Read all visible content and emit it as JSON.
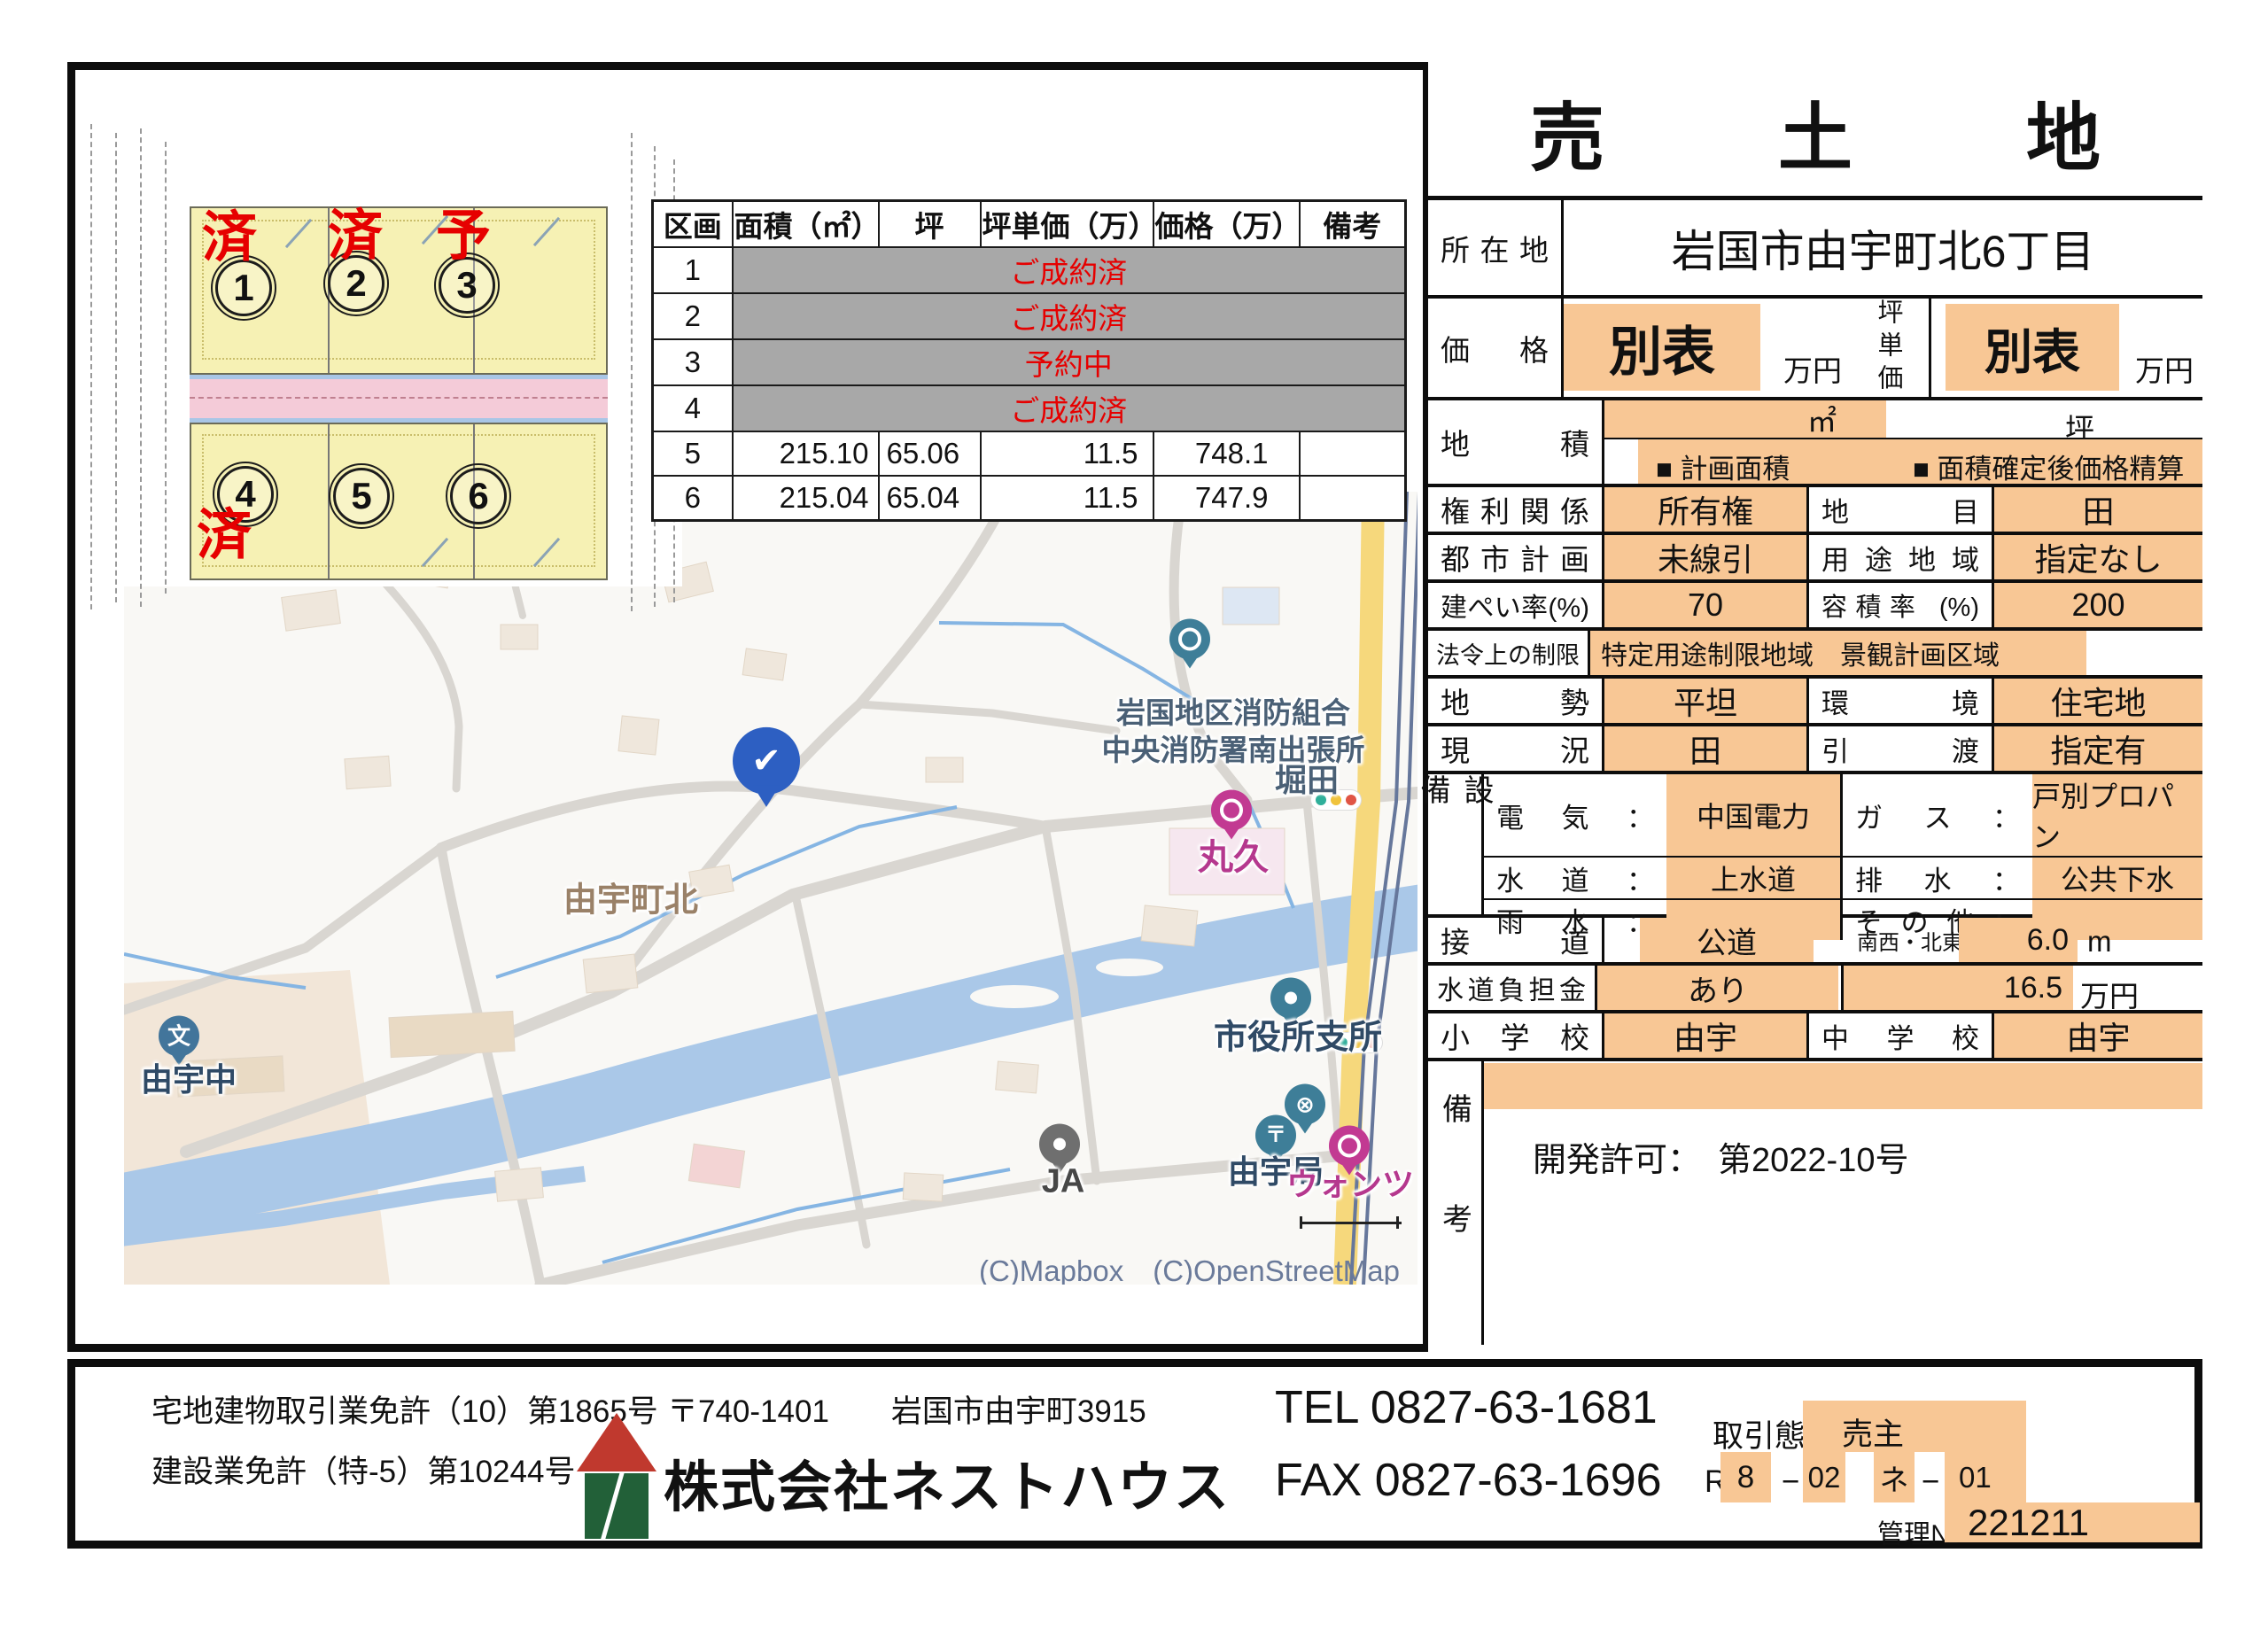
{
  "panel": {
    "title": "売　土　地",
    "location": {
      "label": "所在地",
      "value": "岩国市由宇町北6丁目"
    },
    "price": {
      "label": "価格",
      "value": "別表",
      "unit": "万円",
      "label2": "坪単価",
      "value2": "別表",
      "unit2": "万円"
    },
    "area": {
      "label": "地積",
      "m2": "㎡",
      "tsubo": "坪",
      "check1": "■ 計画面積",
      "check2": "■ 面積確定後価格精算"
    },
    "rights": {
      "label": "権利関係",
      "value": "所有権",
      "label2": "地目",
      "value2": "田"
    },
    "city_plan": {
      "label": "都市計画",
      "value": "未線引",
      "label2": "用途地域",
      "value2": "指定なし"
    },
    "coverage": {
      "label": "建ぺい率(%)",
      "value": "70",
      "label2": "容積率 (%)",
      "value2": "200"
    },
    "law": {
      "label": "法令上の制限",
      "value": "特定用途制限地域　景観計画区域"
    },
    "terrain": {
      "label": "地勢",
      "value": "平坦",
      "label2": "環境",
      "value2": "住宅地"
    },
    "current": {
      "label": "現況",
      "value": "田",
      "label2": "引渡",
      "value2": "指定有"
    },
    "utility": {
      "label": "設備",
      "rows": [
        {
          "label1": "電気：",
          "value1": "中国電力",
          "label2": "ガス：",
          "value2": "戸別プロパン"
        },
        {
          "label1": "水道：",
          "value1": "上水道",
          "label2": "排水：",
          "value2": "公共下水"
        },
        {
          "label1": "雨水：",
          "value1": "",
          "label2": "その他：",
          "value2": ""
        }
      ]
    },
    "road": {
      "label": "接道",
      "value": "公道",
      "side": "南西・北東側",
      "width": "6.0",
      "unit": "m"
    },
    "water_fee": {
      "label": "水道負担金",
      "value": "あり",
      "amount": "16.5",
      "unit": "万円"
    },
    "school": {
      "label": "小学校",
      "value": "由宇",
      "label2": "中学校",
      "value2": "由宇"
    },
    "remarks": {
      "label": "備考",
      "text": "開発許可：　第2022-10号"
    }
  },
  "lot_table": {
    "headers": [
      "区画",
      "面積（㎡）",
      "坪",
      "坪単価（万）",
      "価格（万）",
      "備考"
    ],
    "sold_rows": [
      {
        "no": "1",
        "status": "ご成約済"
      },
      {
        "no": "2",
        "status": "ご成約済"
      },
      {
        "no": "3",
        "status": "予約中"
      },
      {
        "no": "4",
        "status": "ご成約済"
      }
    ],
    "open_rows": [
      {
        "no": "5",
        "area": "215.10",
        "tsubo": "65.06",
        "unit_price": "11.5",
        "price": "748.1",
        "note": ""
      },
      {
        "no": "6",
        "area": "215.04",
        "tsubo": "65.04",
        "unit_price": "11.5",
        "price": "747.9",
        "note": ""
      }
    ]
  },
  "plot": {
    "marks": {
      "lot1": "済",
      "lot2": "済",
      "lot3": "予",
      "lot4": "済"
    },
    "numbers": [
      "1",
      "2",
      "3",
      "4",
      "5",
      "6"
    ]
  },
  "map": {
    "labels": {
      "fire_line1": "岩国地区消防組合",
      "fire_line2": "中央消防署南出張所",
      "hotta": "堀田",
      "marukyu": "丸久",
      "town": "由宇町北",
      "school": "由宇中",
      "city_office": "市役所支所",
      "post_office": "由宇局",
      "wants": "ウォンツ",
      "ja": "JA"
    },
    "icons": {
      "check": "✔",
      "post": "〒",
      "school": "文",
      "cross": "⊗"
    },
    "attribution": "(C)Mapbox　(C)OpenStreetMap　(C)Yahoo Japan　Yahoo!地図ガイド"
  },
  "footer": {
    "license1": "宅地建物取引業免許（10）第1865号",
    "license2": "建設業免許（特-5）第10244号",
    "address": "〒740-1401　　岩国市由宇町3915",
    "company": "株式会社ネストハウス",
    "tel": "TEL 0827-63-1681",
    "fax": "FAX 0827-63-1696",
    "deal_label": "取引態様/",
    "deal_value": "売主",
    "code": {
      "p1": "R",
      "p2": "8",
      "p3": "−",
      "p4": "02",
      "p5": "ネ",
      "p6": "−",
      "p7": "01"
    },
    "mgmt_label": "管理№",
    "mgmt_no": "221211"
  },
  "colors": {
    "accent_orange": "#f8c795",
    "sold_gray": "#a8a8a8",
    "status_red": "#e60000",
    "pin_teal": "#3e7e98",
    "pin_blue": "#2d5fc2",
    "pin_magenta": "#c23a92"
  }
}
